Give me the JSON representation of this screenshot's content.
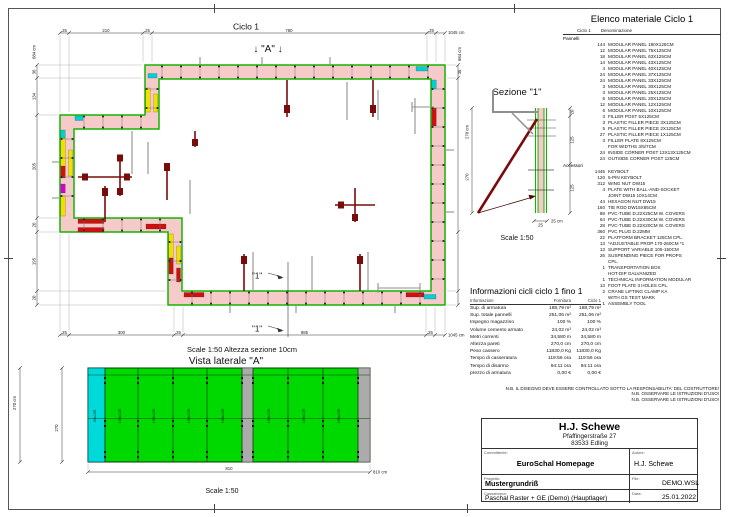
{
  "plan": {
    "title": "Ciclo 1",
    "cut_a": "↓ \"A\" ↓",
    "cut_1_upper": "\"1\"",
    "cut_1_lower": "\"1\"",
    "scale_note": "Scale 1:50   Altezza sezione 10cm",
    "dims": {
      "top": [
        "25",
        "210",
        "25",
        "780",
        "25"
      ],
      "top_total": "1045 cm",
      "left": [
        "36",
        "134",
        "205",
        "20",
        "195",
        "20"
      ],
      "left_total": "684 cm",
      "right": [
        "36"
      ],
      "right_total": "684 cm",
      "bottom": [
        "25",
        "300",
        "25",
        "885",
        "25"
      ],
      "bottom_total": "1045 cm"
    }
  },
  "elevation": {
    "title": "Vista laterale \"A\"",
    "scale": "Scale 1:50",
    "dim_left_total": "270 cm",
    "dim_left_inner": "270",
    "dim_bottom": "810",
    "dim_bottom_total": "810 cm",
    "panel_label": "190x125",
    "filler_label": "43x125"
  },
  "section": {
    "title": "Sezione \"1\"",
    "scale": "Scale 1:50",
    "dim_left_total": "270 cm",
    "dim_left_inner": "270",
    "dim_right_top": "20",
    "dim_right_mid": "125",
    "dim_right_bot": "125",
    "dim_thickness": "25",
    "dim_thickness_unit": "25 cm"
  },
  "material_list": {
    "title": "Elenco materiale  Ciclo 1",
    "col_cycle": "Ciclo 1",
    "col_name": "Denominazione",
    "group_panels": "Pannelli",
    "group_accessories": "Accessori",
    "panels": [
      {
        "q": "144",
        "n": "MODULAR PANEL 190X125CM"
      },
      {
        "q": "12",
        "n": "MODULAR PANEL 75X125CM"
      },
      {
        "q": "18",
        "n": "MODULAR PANEL 63X125CM"
      },
      {
        "q": "14",
        "n": "MODULAR PANEL 43X125CM"
      },
      {
        "q": "4",
        "n": "MODULAR PANEL 40X125CM"
      },
      {
        "q": "24",
        "n": "MODULAR PANEL 37X125CM"
      },
      {
        "q": "24",
        "n": "MODULAR PANEL 33X125CM"
      },
      {
        "q": "3",
        "n": "MODULAR PANEL 30X125CM"
      },
      {
        "q": "3",
        "n": "MODULAR PANEL 25X125CM"
      },
      {
        "q": "6",
        "n": "MODULAR PANEL 20X125CM"
      },
      {
        "q": "12",
        "n": "MODULAR PANEL 12X125CM"
      },
      {
        "q": "6",
        "n": "MODULAR PANEL 10X125CM"
      },
      {
        "q": "3",
        "n": "FILLER POST 5X125CM"
      },
      {
        "q": "3",
        "n": "PLASTIC FILLER PIECE 3X125CM"
      },
      {
        "q": "5",
        "n": "PLASTIC FILLER PIECE 2X125CM"
      },
      {
        "q": "27",
        "n": "PLASTIC FILLER PIECE 1X125CM"
      },
      {
        "q": "3",
        "n": "FILLER PLATE 8X125CM"
      },
      {
        "q": "",
        "n": "FOR WIDTHS 3/5/7CM"
      },
      {
        "q": "24",
        "n": "INSIDE CORNER POST 13X13X125CM"
      },
      {
        "q": "24",
        "n": "OUTSIDE CORNER POST 125CM"
      }
    ],
    "accessories": [
      {
        "q": "1445",
        "n": "KEYBOLT"
      },
      {
        "q": "120",
        "n": "5-PIN KEYBOLT"
      },
      {
        "q": "312",
        "n": "WING NUT DW15"
      },
      {
        "q": "4",
        "n": "PLATE WITH BALL-AND-SOCKET"
      },
      {
        "q": "",
        "n": "JOINT DW15 10X14CM"
      },
      {
        "q": "44",
        "n": "HEXAGON NUT DW15"
      },
      {
        "q": "160",
        "n": "TIE ROD DW15X85CM"
      },
      {
        "q": "88",
        "n": "PVC-TUBE D.22X25CM W. COVERS"
      },
      {
        "q": "64",
        "n": "PVC-TUBE D.22X30CM W. COVERS"
      },
      {
        "q": "28",
        "n": "PVC-TUBE D.22X20CM W. COVERS"
      },
      {
        "q": "360",
        "n": "PVC PLUG D.22MM"
      },
      {
        "q": "22",
        "n": "PLATFORM BRACKET 125CM CPL."
      },
      {
        "q": "13",
        "n": "*ADJUSTABLE PROP 170-260CM *1"
      },
      {
        "q": "13",
        "n": "SUPPORT VARIABLE 105-150CM"
      },
      {
        "q": "26",
        "n": "SUSPENDING PIECE FOR PROPS"
      },
      {
        "q": "",
        "n": "CPL."
      },
      {
        "q": "1",
        "n": "TRANSPORTATION BOX"
      },
      {
        "q": "",
        "n": "HOT-DIP GALVANIZED"
      },
      {
        "q": "1",
        "n": "TECHNICAL INFORMATION MODULAR"
      },
      {
        "q": "13",
        "n": "FOOT PLATE 3 HOLES CPL."
      },
      {
        "q": "2",
        "n": "CRANE LIFTING CLAMP KA"
      },
      {
        "q": "",
        "n": "WITH GS TEST MARK"
      },
      {
        "q": "1",
        "n": "ASSEMBLY TOOL"
      }
    ]
  },
  "info_table": {
    "title": "Informazioni cicli  ciclo 1 fino 1",
    "col_info": "Informazioni",
    "col_supply": "Fornitura",
    "col_cycle": "Ciclo 1",
    "rows": [
      [
        "Sup. di armatura",
        "188,79 m²",
        "188,79 m²"
      ],
      [
        "Sup. totale pannelli",
        "251,06 m²",
        "251,06 m²"
      ],
      [
        "Impegno magazzino",
        "100 %",
        "100 %"
      ],
      [
        "Volume cemento armato",
        "24,02 m³",
        "24,02 m³"
      ],
      [
        "Metri correnti",
        "34,580 m",
        "34,580 m"
      ],
      [
        "Altezza pareti",
        "270,0 cm",
        "270,0 cm"
      ],
      [
        "Peso cassero",
        "11830,0 Kg",
        "11830,0 Kg"
      ],
      [
        "Tempo di casseratura",
        "119:56 ora",
        "119:56 ora"
      ],
      [
        "Tempo di disarmo",
        "94:11 ora",
        "94:11 ora"
      ],
      [
        "prezzo di armatura",
        "0,00 €",
        "0,00 €"
      ]
    ]
  },
  "notes": [
    "N.B. IL DISEGNO DEVE ESSERE CONTROLLATO SOTTO LA RESPONSABILITA' DEL COSTRUTTORE!",
    "N.B. OSSERVARE LE ISTRUZIONI D'USO!",
    "N.B. OSSERVARE LE ISTRUZIONI D'USO!"
  ],
  "title_block": {
    "company": "H.J. Schewe",
    "address1": "Pfaffingerstraße 27",
    "address2": "83533 Edling",
    "client_label": "Committente:",
    "client": "EuroSchal Homepage",
    "author_label": "Autore:",
    "author": "H.J. Schewe",
    "project_label": "Progetto:",
    "project": "Mustergrundriß",
    "file_label": "File:",
    "file": "DEMO.WSL",
    "formwork_label": "Cassaforma:",
    "formwork": "Paschal Raster + GE (Demo) (Hauptlager)",
    "date_label": "Data:",
    "date": "25.01.2022"
  }
}
